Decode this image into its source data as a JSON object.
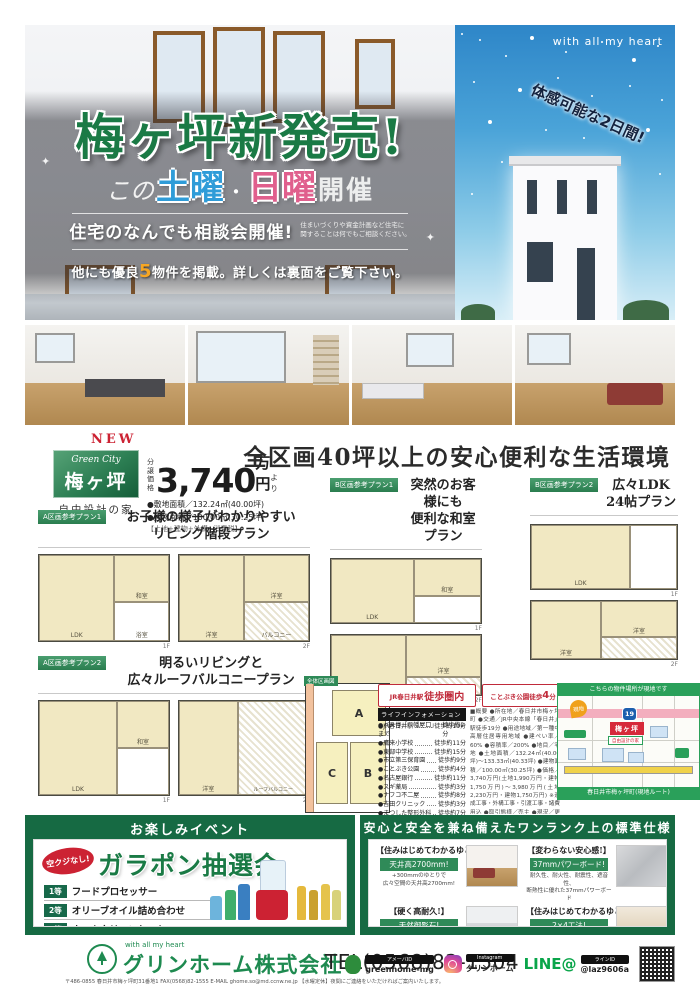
{
  "hero": {
    "brand_tagline": "with all my heart",
    "title": "梅ヶ坪新発売!",
    "sub_prefix": "この",
    "sub_sat": "土曜",
    "sub_dot": "・",
    "sub_sun": "日曜",
    "sub_suffix": "開催",
    "consult_title": "住宅のなんでも相談会開催!",
    "consult_note1": "住まいづくりや資金計画など住宅に",
    "consult_note2": "関することは何でもご相談ください。",
    "more_pre": "他にも優良",
    "more_num": "5",
    "more_post": "物件を掲載。詳しくは裏面をご覧下さい。",
    "experience_badge": "体感可能な2日間!",
    "sparkle": "✦"
  },
  "property": {
    "new_label": "NEW",
    "badge_top": "Green City",
    "badge_name": "梅ヶ坪",
    "badge_sub": "自由設計の家",
    "price_label1": "分譲",
    "price_label2": "価格",
    "price_value": "3,740",
    "price_unit": "万円",
    "price_more": "より",
    "land_area": "●敷地面積／132.24㎡(40.00坪)",
    "building_area": "●建物面積／100.00㎡(30.25坪)",
    "price_note": "【土地+建物+外構+消費税】",
    "headline": "全区画40坪以上の安心便利な生活環境"
  },
  "plans": {
    "a1": {
      "tag": "A区画参考プラン1",
      "cap1": "お子様の様子がわかりやすい",
      "cap2": "リビング階段プラン",
      "f1": "1F",
      "f2": "2F",
      "rooms": [
        "LDK",
        "和室",
        "浴室",
        "洋室",
        "洋室",
        "バルコニー"
      ]
    },
    "b1": {
      "tag": "B区画参考プラン1",
      "cap1": "突然のお客様にも",
      "cap2": "便利な和室プラン",
      "f1": "1F",
      "f2": "2F",
      "rooms": [
        "LDK",
        "和室",
        "洋室",
        "洋室"
      ]
    },
    "b2": {
      "tag": "B区画参考プラン2",
      "cap1": "広々LDK",
      "cap2": "24帖プラン",
      "f1": "1F",
      "f2": "2F",
      "rooms": [
        "LDK",
        "洋室",
        "洋室"
      ]
    },
    "a2": {
      "tag": "A区画参考プラン2",
      "cap1": "明るいリビングと",
      "cap2": "広々ルーフバルコニープラン",
      "f1": "1F",
      "f2": "2F",
      "rooms": [
        "LDK",
        "和室",
        "洋室",
        "ルーフバルコニー"
      ]
    }
  },
  "lots": {
    "tag": "全体区画図",
    "a": "A",
    "b": "B",
    "c": "C"
  },
  "access": {
    "station_badge_small": "JR春日井駅",
    "station_badge_big": "徒歩圏内",
    "park_badge_small": "ことぶき公園徒歩",
    "park_badge_num": "4",
    "park_badge_suffix": "分",
    "info_title": "ライフインフォメーション",
    "items": [
      {
        "name": "●JR春日井駅",
        "time": "徒歩約19分"
      },
      {
        "name": "●バス停「八幡屋口」まで",
        "time": "徒歩約2分"
      },
      {
        "name": "●鷹来小学校",
        "time": "徒歩約11分"
      },
      {
        "name": "●東部中学校",
        "time": "徒歩約15分"
      },
      {
        "name": "●市立第三保育園",
        "time": "徒歩約9分"
      },
      {
        "name": "●ことぶき公園",
        "time": "徒歩約4分"
      },
      {
        "name": "●名古屋銀行",
        "time": "徒歩約11分"
      },
      {
        "name": "●スギ薬局",
        "time": "徒歩約3分"
      },
      {
        "name": "●ナフコ不二屋",
        "time": "徒歩約8分"
      },
      {
        "name": "●吉田クリニック",
        "time": "徒歩約3分"
      },
      {
        "name": "●まつした整形外科",
        "time": "徒歩約7分"
      }
    ],
    "overview": "■概要 ●所在地／春日井市梅ヶ坪町 ●交通／JR中央本線「春日井」駅徒歩19分 ●用途地域／第一種中高層住居専用地域 ●建ぺい率／60% ●容積率／200% ●地目／宅地 ●土地面積／132.24㎡(40.00坪)〜133.33㎡(40.33坪) ●建物面積／100.00㎡(30.25坪) ●価格／3,740万円(土地1,990万円・建物1,750万円)〜3,980万円(土地2,230万円・建物1,750万円) ※造成工事・外構工事・引渡工事・諸費用込 ●取引態様／売主 ●現況／更地・上下水道 ※詳細はお問い合せ下さい(予定)"
  },
  "map": {
    "header": "こちらの物件場所が現地です",
    "route": "19",
    "marker": "現地",
    "site": "梅ヶ坪",
    "site_sub": "自由設計の家",
    "footer": "春日井市梅ヶ坪町(現地ルート)"
  },
  "event": {
    "header": "お楽しみイベント",
    "badge": "空クジなし!",
    "title": "ガラポン抽選会",
    "prizes": [
      {
        "rank": "1等",
        "item": "フードプロセッサー"
      },
      {
        "rank": "2等",
        "item": "オリーブオイル詰め合わせ"
      },
      {
        "rank": "3等",
        "item": "ホームクリーンセット"
      }
    ]
  },
  "specs": {
    "header": "安心と安全を兼ね備えたワンランク上の標準仕様",
    "items": [
      {
        "title": "【住みはじめてわかるゆとり】",
        "bar": "天井高2700mm!",
        "desc1": "+300mmのゆとりで",
        "desc2": "広々空間の天井高2700mm!"
      },
      {
        "title": "【変わらない安心感!】",
        "bar": "37mmパワーボード!",
        "desc1": "耐久性、耐火性、耐震性、遮音性、",
        "desc2": "断熱性に優れた37mmパワーボード"
      },
      {
        "title": "【硬く高耐久!】",
        "bar": "天然御影石!",
        "desc1": "天然御影石",
        "desc2": "システムキッチン!"
      },
      {
        "title": "【住みはじめてわかるゆとり】",
        "bar": "2×4工法!",
        "desc1": "火災、地震に強い",
        "desc2": "2×4工法!"
      }
    ]
  },
  "footer": {
    "tagline": "with all my heart",
    "company": "グリンホーム株式会社",
    "tel": "TEL(0568)82-1504",
    "address": "〒486-0855 春日井市梅ヶ坪町31番地1 FAX(0568)82-1555 E-MAIL ghome.so@md.ccnw.ne.jp 【水曜定休】夜間にご連絡をいただければご案内いたします。",
    "ameba_badge": "アメーバID",
    "ameba_id": "greenhome-mg",
    "insta_badge": "Instagram",
    "insta_id": "グリンホーム",
    "line_label": "LINE@",
    "line_badge": "ラインID",
    "line_id": "@laz9606a"
  }
}
